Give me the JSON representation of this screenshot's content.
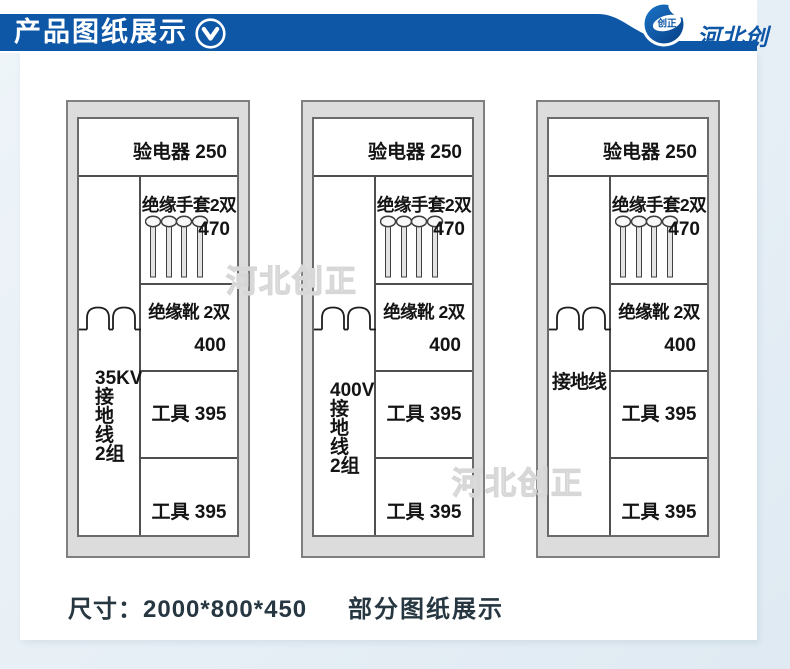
{
  "colors": {
    "accent_blue": "#0e57a7",
    "cabinet_fill": "#dcdcdc"
  },
  "header": {
    "title": "产品图纸展示",
    "brand": "河北创正",
    "logo_badge": "创正"
  },
  "watermark": {
    "text": "河北创正"
  },
  "cabinets": [
    {
      "tester": "验电器 250",
      "gloves": "绝缘手套2双",
      "gloves_height": "470",
      "boots": "绝缘靴 2双",
      "boots_height": "400",
      "tools_upper": "工具 395",
      "tools_lower": "工具 395",
      "ground_lines": [
        "35KV",
        "接",
        "地",
        "线",
        "2组"
      ]
    },
    {
      "tester": "验电器 250",
      "gloves": "绝缘手套2双",
      "gloves_height": "470",
      "boots": "绝缘靴 2双",
      "boots_height": "400",
      "tools_upper": "工具 395",
      "tools_lower": "工具 395",
      "ground_lines": [
        "400V",
        "接",
        "地",
        "线",
        "2组"
      ]
    },
    {
      "tester": "验电器 250",
      "gloves": "绝缘手套2双",
      "gloves_height": "470",
      "boots": "绝缘靴 2双",
      "boots_height": "400",
      "tools_upper": "工具 395",
      "tools_lower": "工具 395",
      "ground_lines": [
        "接地线"
      ]
    }
  ],
  "footer": {
    "dimensions": "尺寸：2000*800*450",
    "caption": "部分图纸展示"
  }
}
